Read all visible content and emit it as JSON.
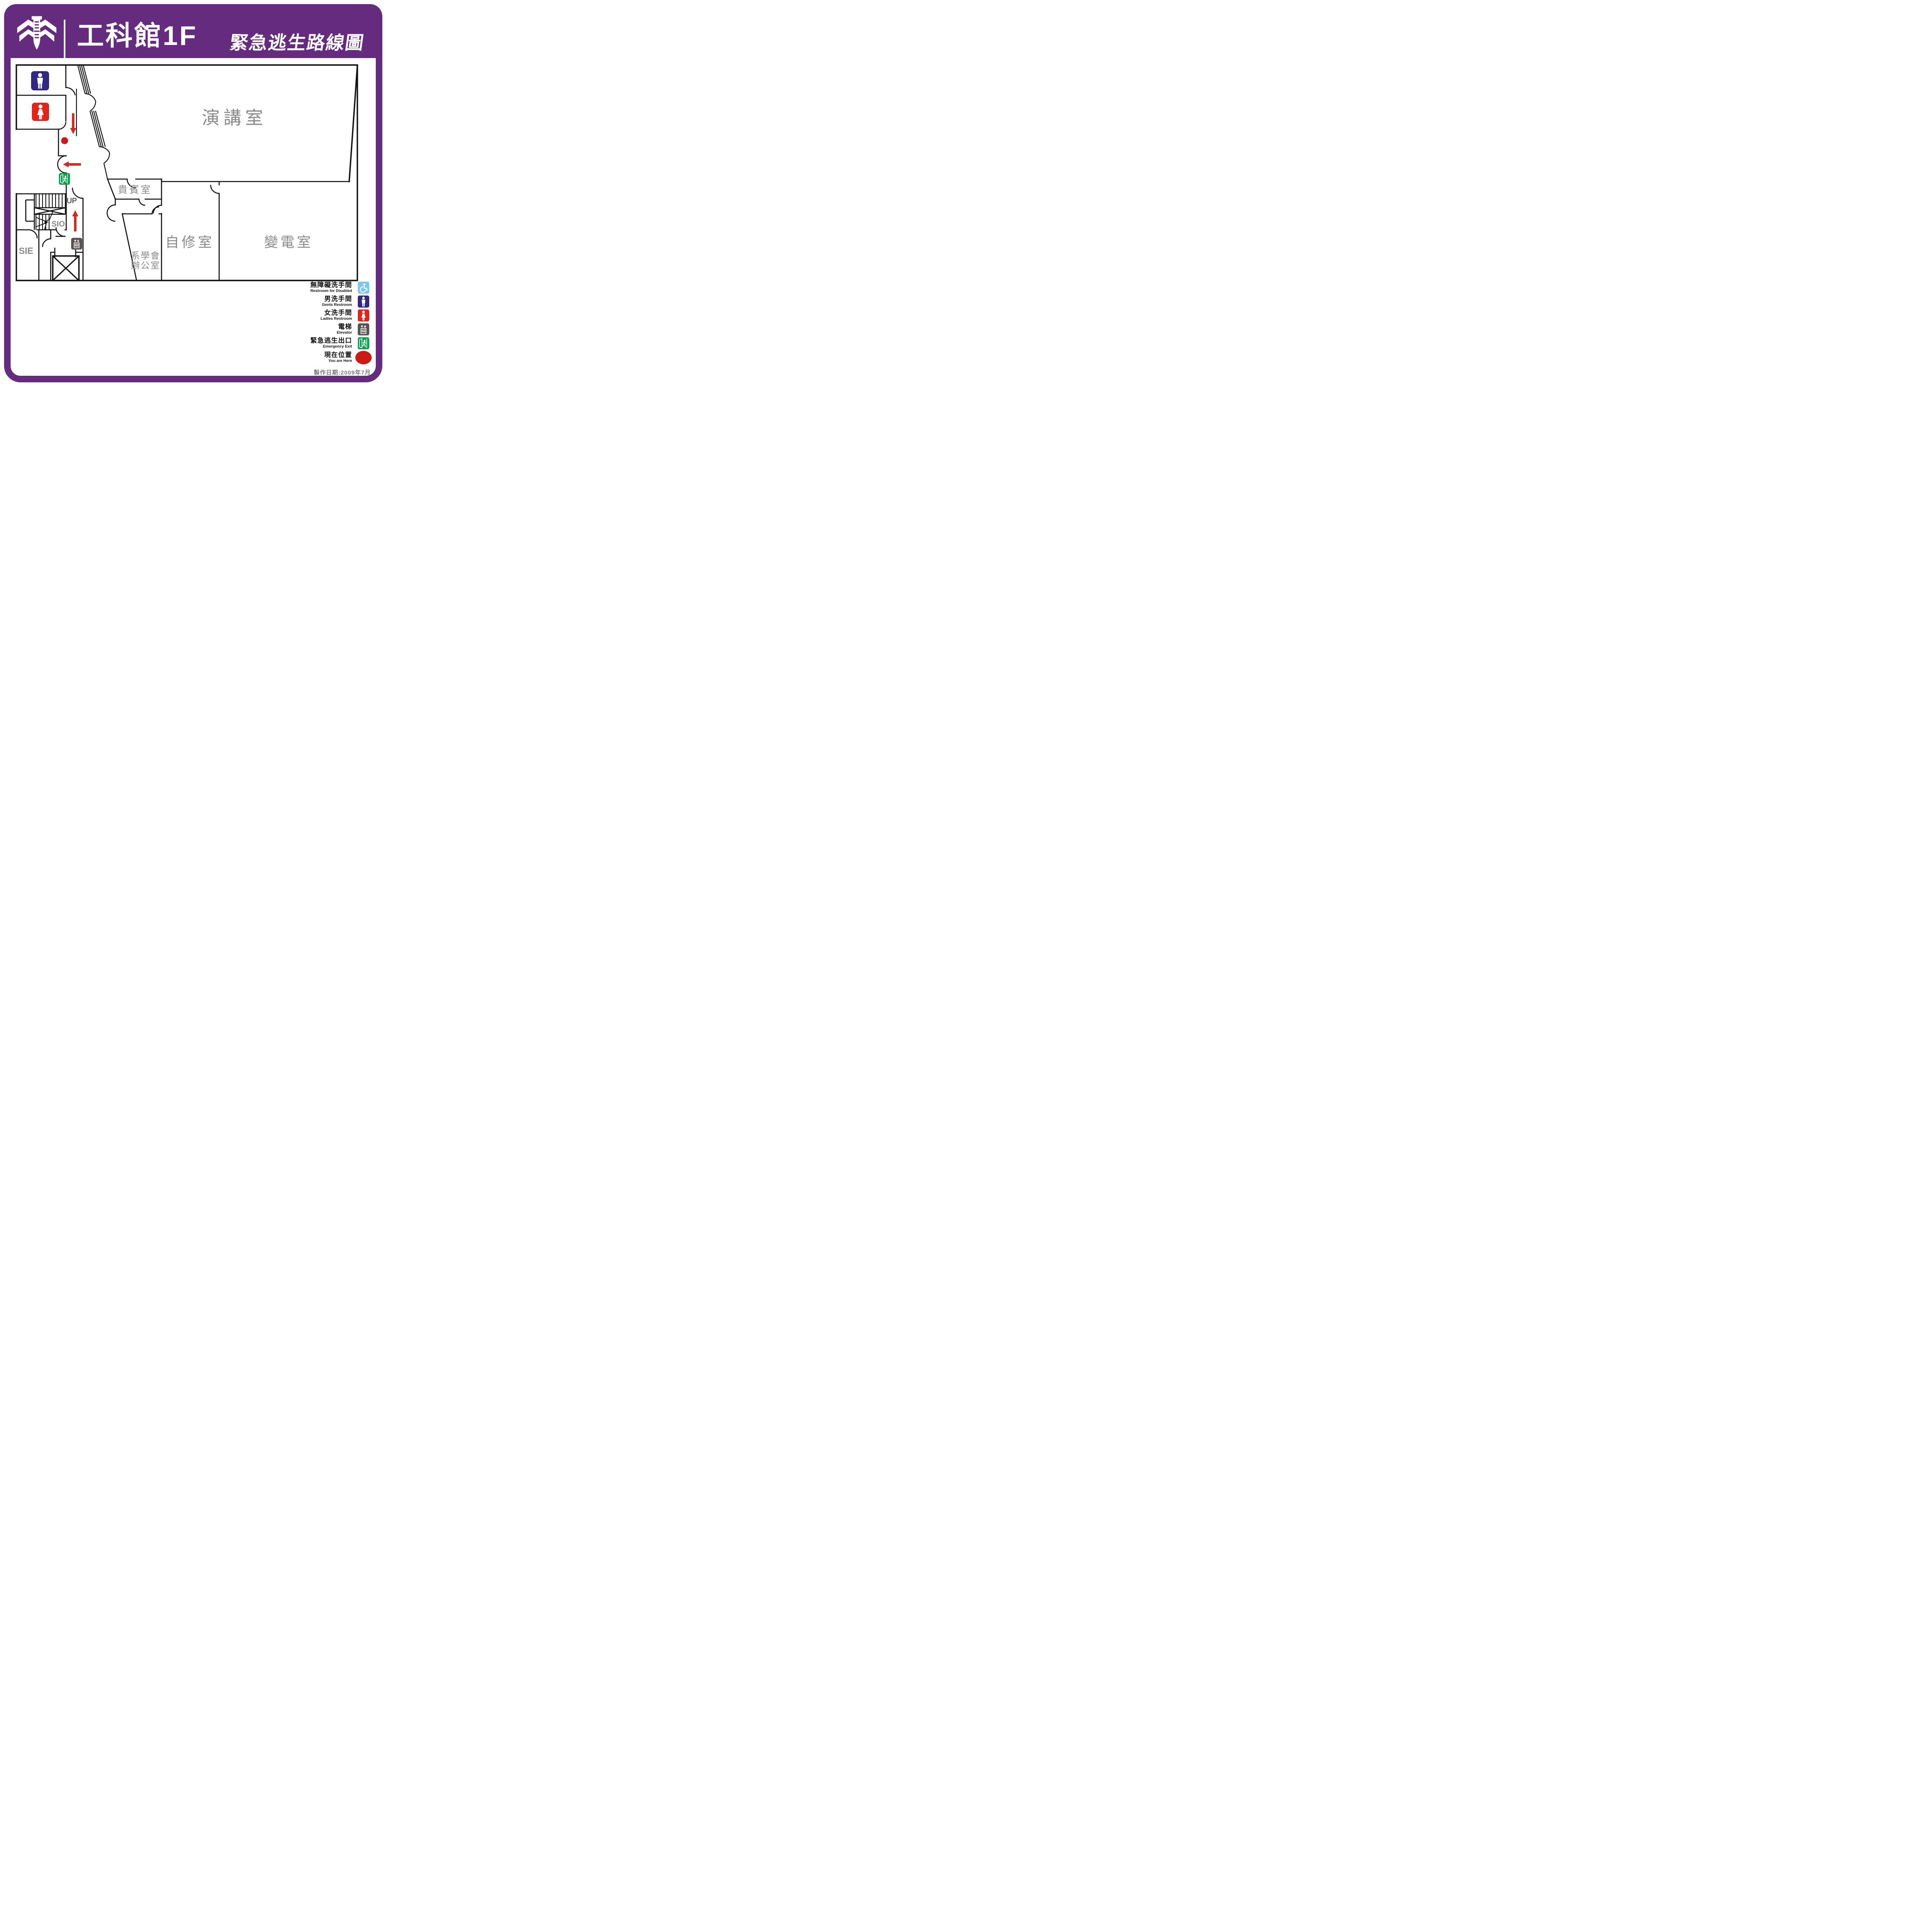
{
  "page": {
    "type": "emergency-evacuation-route-sign"
  },
  "colors": {
    "frame_purple": "#652B7E",
    "wall_black": "#111111",
    "room_label_gray": "#8A8A8A",
    "route_red": "#D6281E",
    "you_are_here_red": "#CE1A17",
    "exit_green": "#0AA14E",
    "gents_navy": "#312884",
    "ladies_red": "#E1251B",
    "accessible_blue": "#7CC7EF",
    "elevator_gray": "#595252",
    "date_gray": "#7B7878"
  },
  "header": {
    "building_name": "工科館1F",
    "map_title": "緊急逃生路線圖"
  },
  "floor_plan": {
    "rooms": [
      {
        "id": "lecture",
        "label": "演講室"
      },
      {
        "id": "vip",
        "label": "貴賓室"
      },
      {
        "id": "self_study",
        "label": "自修室"
      },
      {
        "id": "transformer",
        "label": "變電室"
      },
      {
        "id": "assoc_office",
        "label_line1": "系學會",
        "label_line2": "辦公室"
      },
      {
        "id": "sio",
        "label": "SIO"
      },
      {
        "id": "sie",
        "label": "SIE"
      }
    ],
    "stairs_label": "UP"
  },
  "legend": {
    "items": [
      {
        "zh": "無障礙洗手間",
        "en": "Restroom for Disabled",
        "icon": "wheelchair-icon"
      },
      {
        "zh": "男洗手間",
        "en": "Gents Restroom",
        "icon": "male-icon"
      },
      {
        "zh": "女洗手間",
        "en": "Ladies Restroom",
        "icon": "female-icon"
      },
      {
        "zh": "電梯",
        "en": "Elevator",
        "icon": "elevator-icon"
      },
      {
        "zh": "緊急逃生出口",
        "en": "Emergency Exit",
        "icon": "emergency-exit-icon"
      },
      {
        "zh": "現在位置",
        "en": "You are Here",
        "icon": "you-are-here-dot"
      }
    ]
  },
  "footer": {
    "production_date": "製作日期:2009年7月"
  }
}
